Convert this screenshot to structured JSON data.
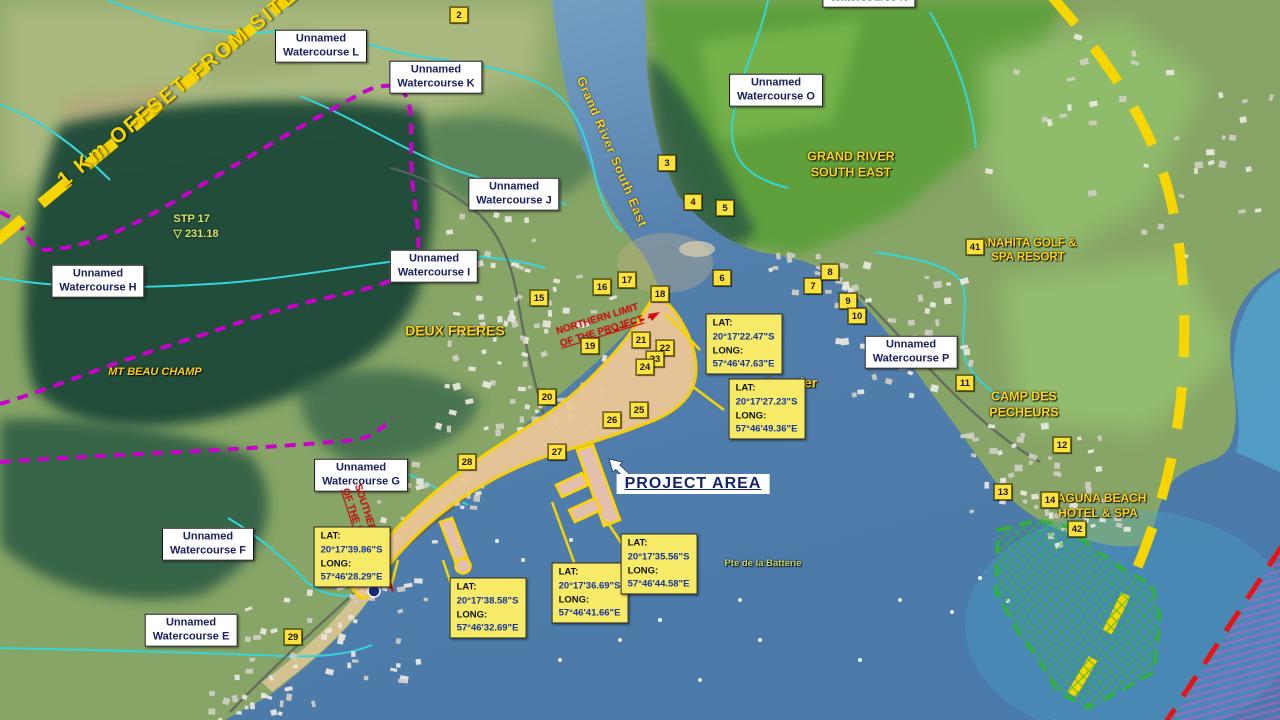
{
  "figure": {
    "offset_label": "1 Km OFFSET FROM SITE",
    "river_label": "Grand River South East",
    "project_area": {
      "label": "PROJECT AREA"
    },
    "survey_point": {
      "name": "STP  17",
      "symbol": "▽",
      "elevation": "231.18"
    },
    "coord_field_labels": {
      "lat": "LAT:",
      "long": "LONG:"
    },
    "watercourses": [
      {
        "id": "L",
        "line1": "Unnamed",
        "line2": "Watercourse L",
        "x": 321,
        "y": 46
      },
      {
        "id": "K",
        "line1": "Unnamed",
        "line2": "Watercourse K",
        "x": 436,
        "y": 77
      },
      {
        "id": "J",
        "line1": "Unnamed",
        "line2": "Watercourse J",
        "x": 514,
        "y": 194
      },
      {
        "id": "I",
        "line1": "Unnamed",
        "line2": "Watercourse I",
        "x": 434,
        "y": 266
      },
      {
        "id": "H",
        "line1": "Unnamed",
        "line2": "Watercourse H",
        "x": 98,
        "y": 281
      },
      {
        "id": "G",
        "line1": "Unnamed",
        "line2": "Watercourse G",
        "x": 361,
        "y": 475
      },
      {
        "id": "F",
        "line1": "Unnamed",
        "line2": "Watercourse F",
        "x": 208,
        "y": 544
      },
      {
        "id": "E",
        "line1": "Unnamed",
        "line2": "Watercourse E",
        "x": 191,
        "y": 630
      },
      {
        "id": "N",
        "line1": "Unnamed",
        "line2": "Watercourse N",
        "x": 869,
        "y": -9
      },
      {
        "id": "O",
        "line1": "Unnamed",
        "line2": "Watercourse O",
        "x": 776,
        "y": 90
      },
      {
        "id": "P",
        "line1": "Unnamed",
        "line2": "Watercourse P",
        "x": 911,
        "y": 352
      }
    ],
    "places": [
      {
        "id": "grand-river-south-east",
        "lines": [
          "GRAND RIVER",
          "SOUTH EAST"
        ],
        "x": 851,
        "y": 165,
        "size": 12.5
      },
      {
        "id": "anahita-golf-spa-resort",
        "lines": [
          "ANAHITA GOLF &",
          "SPA RESORT"
        ],
        "x": 1028,
        "y": 251,
        "size": 11.5
      },
      {
        "id": "deux-freres",
        "lines": [
          "DEUX FRERES"
        ],
        "x": 455,
        "y": 331,
        "size": 14
      },
      {
        "id": "mt-beau-champ",
        "lines": [
          "MT BEAU CHAMP"
        ],
        "x": 155,
        "y": 373,
        "size": 11,
        "italic": true
      },
      {
        "id": "camp-des-pecheurs",
        "lines": [
          "CAMP DES",
          "PECHEURS"
        ],
        "x": 1024,
        "y": 405,
        "size": 12.5
      },
      {
        "id": "laguna-beach-hotel-spa",
        "lines": [
          "LAGUNA BEACH",
          "HOTEL & SPA"
        ],
        "x": 1098,
        "y": 506,
        "size": 12
      },
      {
        "id": "quartier",
        "lines": [
          "Quartier"
        ],
        "x": 790,
        "y": 383,
        "size": 14
      },
      {
        "id": "pte-de-la-batterie",
        "lines": [
          "Pte de la  Batterie"
        ],
        "x": 763,
        "y": 564,
        "size": 9.5,
        "color": "#c9d86a"
      }
    ],
    "limits": [
      {
        "id": "northern-limit",
        "line1": "NORTHERN LIMIT",
        "line2": "OF THE PROJECT",
        "x": 600,
        "y": 326,
        "rotate": -17
      },
      {
        "id": "southern-limit",
        "line1": "SOUTHERN LIMIT",
        "line2": "OF THE PROJECT",
        "x": 364,
        "y": 528,
        "rotate": 72
      }
    ],
    "coordinates": [
      {
        "lat": "20°17'22.47\"S",
        "long": "57°46'47.63\"E",
        "x": 744,
        "y": 344
      },
      {
        "lat": "20°17'27.23\"S",
        "long": "57°46'49.36\"E",
        "x": 767,
        "y": 409
      },
      {
        "lat": "20°17'39.86\"S",
        "long": "57°46'28.29\"E",
        "x": 352,
        "y": 557
      },
      {
        "lat": "20°17'38.58\"S",
        "long": "57°46'32.69\"E",
        "x": 488,
        "y": 608
      },
      {
        "lat": "20°17'36.69\"S",
        "long": "57°46'41.66\"E",
        "x": 590,
        "y": 593
      },
      {
        "lat": "20°17'35.56\"S",
        "long": "57°46'44.58\"E",
        "x": 659,
        "y": 564
      }
    ],
    "markers": [
      {
        "n": "2",
        "x": 459,
        "y": 15
      },
      {
        "n": "3",
        "x": 667,
        "y": 163
      },
      {
        "n": "4",
        "x": 693,
        "y": 202
      },
      {
        "n": "5",
        "x": 725,
        "y": 208
      },
      {
        "n": "6",
        "x": 722,
        "y": 278
      },
      {
        "n": "7",
        "x": 813,
        "y": 286
      },
      {
        "n": "8",
        "x": 830,
        "y": 272
      },
      {
        "n": "9",
        "x": 848,
        "y": 301
      },
      {
        "n": "10",
        "x": 857,
        "y": 316
      },
      {
        "n": "11",
        "x": 965,
        "y": 383
      },
      {
        "n": "12",
        "x": 1062,
        "y": 445
      },
      {
        "n": "13",
        "x": 1003,
        "y": 492
      },
      {
        "n": "14",
        "x": 1050,
        "y": 500
      },
      {
        "n": "15",
        "x": 539,
        "y": 298
      },
      {
        "n": "16",
        "x": 602,
        "y": 287
      },
      {
        "n": "17",
        "x": 627,
        "y": 280
      },
      {
        "n": "18",
        "x": 660,
        "y": 294
      },
      {
        "n": "19",
        "x": 590,
        "y": 346
      },
      {
        "n": "20",
        "x": 547,
        "y": 397
      },
      {
        "n": "21",
        "x": 641,
        "y": 340
      },
      {
        "n": "22",
        "x": 665,
        "y": 348
      },
      {
        "n": "23",
        "x": 655,
        "y": 359
      },
      {
        "n": "24",
        "x": 645,
        "y": 367
      },
      {
        "n": "25",
        "x": 639,
        "y": 410
      },
      {
        "n": "26",
        "x": 612,
        "y": 420
      },
      {
        "n": "27",
        "x": 557,
        "y": 452
      },
      {
        "n": "28",
        "x": 467,
        "y": 462
      },
      {
        "n": "29",
        "x": 293,
        "y": 637
      },
      {
        "n": "41",
        "x": 975,
        "y": 247
      },
      {
        "n": "42",
        "x": 1077,
        "y": 529
      }
    ],
    "legend_colors": {
      "offset_line": "#f7d500",
      "watershed_boundary": "#cc00cc",
      "marine_area_outline": "#2db82d",
      "exclusion_line": "#e01414",
      "project_area_fill": "#ecc795",
      "watercourse_stream": "#35d5dc"
    }
  }
}
